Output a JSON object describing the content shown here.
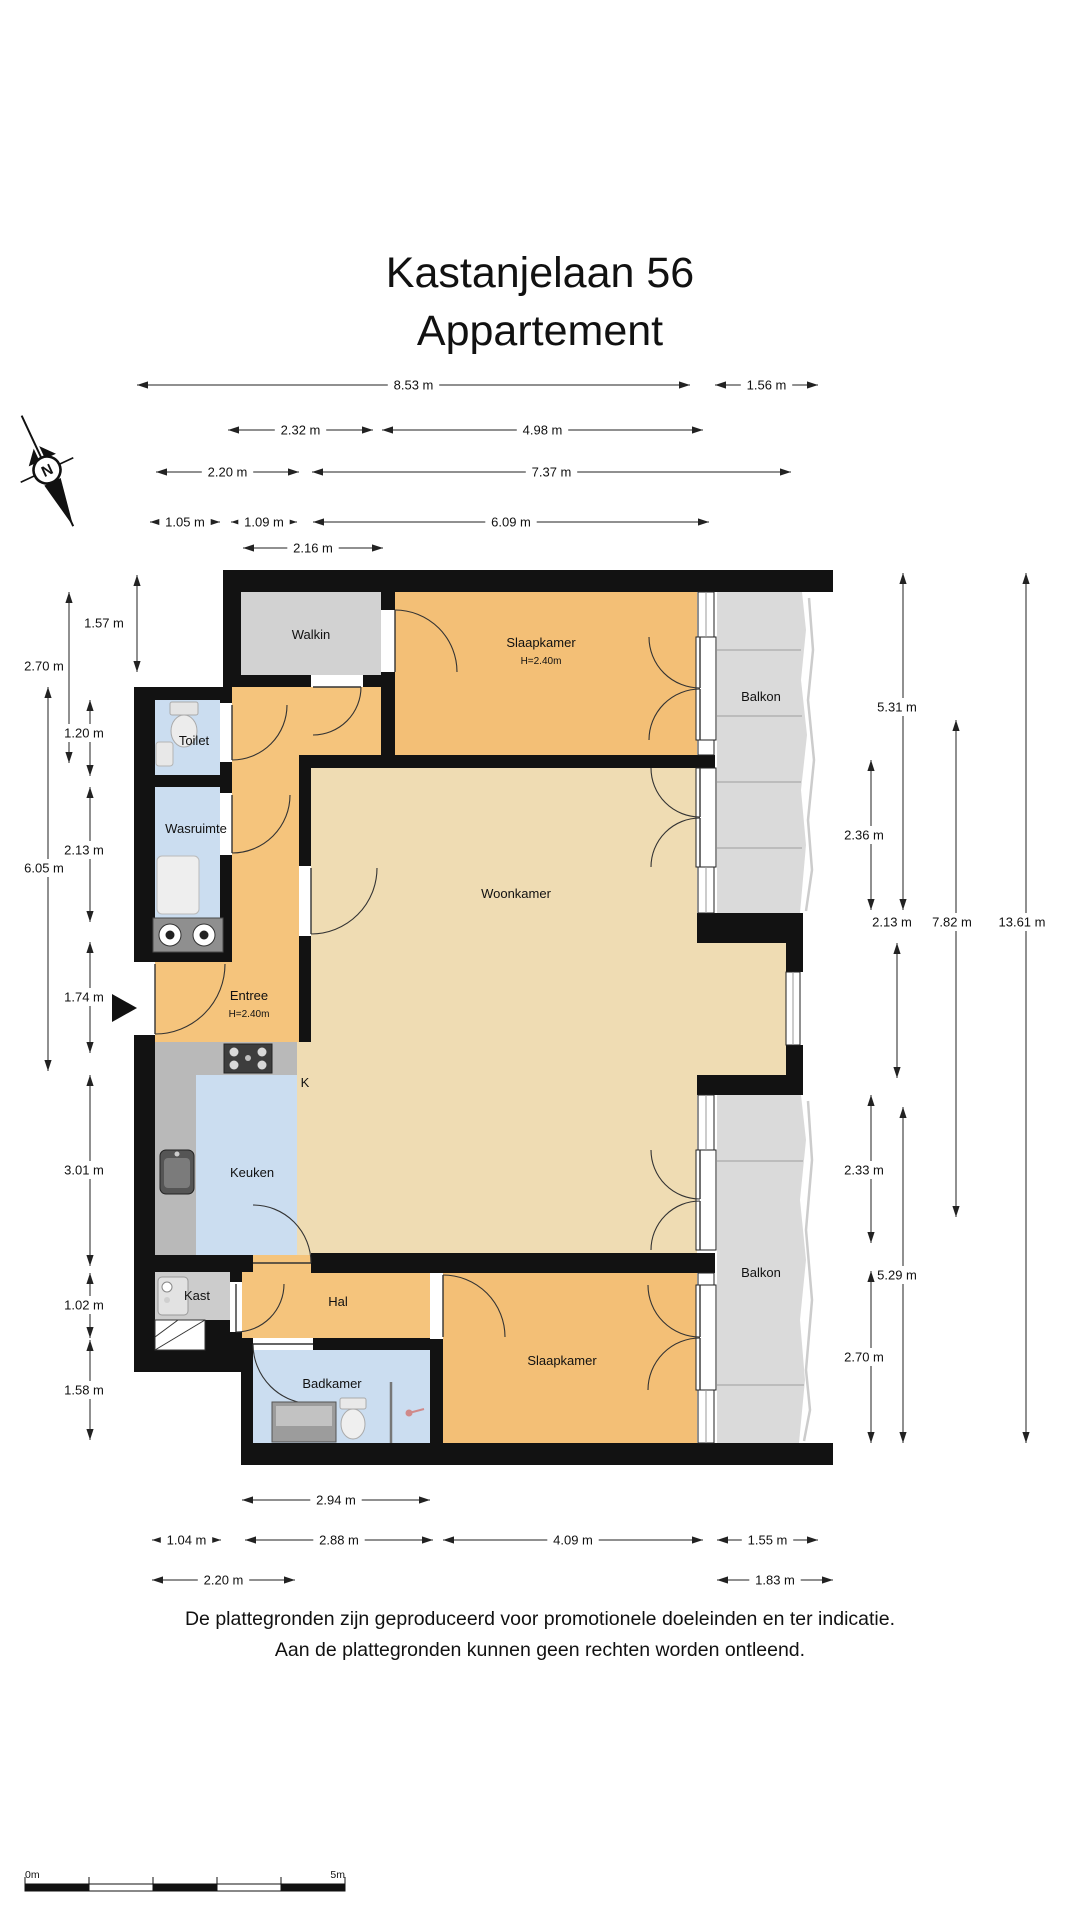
{
  "title": {
    "line1": "Kastanjelaan 56",
    "line2": "Appartement"
  },
  "compass": {
    "label": "N"
  },
  "colors": {
    "wall": "#121212",
    "hall_orange": "#f5c47c",
    "bedroom_orange": "#f3bf76",
    "living_tan": "#efdcb3",
    "wet_blue": "#cbddf0",
    "walkin_grey": "#d2d2d2",
    "balcony_grey": "#dadada",
    "counter_grey": "#b9b9b9"
  },
  "rooms": [
    {
      "name": "walkin",
      "label": "Walkin",
      "x": 311,
      "y": 639
    },
    {
      "name": "slaapkamer-top",
      "label": "Slaapkamer",
      "sublabel": "H=2.40m",
      "x": 541,
      "y": 647,
      "sub_y": 664
    },
    {
      "name": "balkon-top",
      "label": "Balkon",
      "x": 761,
      "y": 701
    },
    {
      "name": "toilet",
      "label": "Toilet",
      "x": 194,
      "y": 745
    },
    {
      "name": "wasruimte",
      "label": "Wasruimte",
      "x": 196,
      "y": 833
    },
    {
      "name": "woonkamer",
      "label": "Woonkamer",
      "x": 516,
      "y": 898
    },
    {
      "name": "entree",
      "label": "Entree",
      "sublabel": "H=2.40m",
      "x": 249,
      "y": 1000,
      "sub_y": 1017
    },
    {
      "name": "keuken-k",
      "label": "K",
      "x": 305,
      "y": 1087
    },
    {
      "name": "keuken",
      "label": "Keuken",
      "x": 252,
      "y": 1177
    },
    {
      "name": "kast",
      "label": "Kast",
      "x": 197,
      "y": 1300
    },
    {
      "name": "hal",
      "label": "Hal",
      "x": 338,
      "y": 1306
    },
    {
      "name": "badkamer",
      "label": "Badkamer",
      "x": 332,
      "y": 1388
    },
    {
      "name": "slaapkamer-bottom",
      "label": "Slaapkamer",
      "x": 562,
      "y": 1365
    },
    {
      "name": "balkon-bottom",
      "label": "Balkon",
      "x": 761,
      "y": 1277
    }
  ],
  "dimensions": {
    "horizontal": [
      {
        "label": "8.53 m",
        "y": 385,
        "x1": 137,
        "x2": 690
      },
      {
        "label": "1.56 m",
        "y": 385,
        "x1": 715,
        "x2": 818
      },
      {
        "label": "2.32 m",
        "y": 430,
        "x1": 228,
        "x2": 373
      },
      {
        "label": "4.98 m",
        "y": 430,
        "x1": 382,
        "x2": 703
      },
      {
        "label": "2.20 m",
        "y": 472,
        "x1": 156,
        "x2": 299
      },
      {
        "label": "7.37 m",
        "y": 472,
        "x1": 312,
        "x2": 791
      },
      {
        "label": "1.05 m",
        "y": 522,
        "x1": 150,
        "x2": 220
      },
      {
        "label": "1.09 m",
        "y": 522,
        "x1": 231,
        "x2": 297
      },
      {
        "label": "6.09 m",
        "y": 522,
        "x1": 313,
        "x2": 709
      },
      {
        "label": "2.16 m",
        "y": 548,
        "x1": 243,
        "x2": 383
      },
      {
        "label": "2.94 m",
        "y": 1500,
        "x1": 242,
        "x2": 430
      },
      {
        "label": "1.04 m",
        "y": 1540,
        "x1": 152,
        "x2": 221
      },
      {
        "label": "2.88 m",
        "y": 1540,
        "x1": 245,
        "x2": 433
      },
      {
        "label": "4.09 m",
        "y": 1540,
        "x1": 443,
        "x2": 703
      },
      {
        "label": "1.55 m",
        "y": 1540,
        "x1": 717,
        "x2": 818
      },
      {
        "label": "2.20 m",
        "y": 1580,
        "x1": 152,
        "x2": 295
      },
      {
        "label": "1.83 m",
        "y": 1580,
        "x1": 717,
        "x2": 833
      }
    ],
    "vertical": [
      {
        "label": "1.57 m",
        "x": 137,
        "y1": 575,
        "y2": 672,
        "lx": 104,
        "ly": 623,
        "bg": false
      },
      {
        "label": "2.70 m",
        "x": 69,
        "y1": 592,
        "y2": 763,
        "lx": 44,
        "ly": 666,
        "bg": false
      },
      {
        "label": "1.20 m",
        "x": 90,
        "y1": 700,
        "y2": 776,
        "lx": 84,
        "ly": 733,
        "bg": true
      },
      {
        "label": "2.13 m",
        "x": 90,
        "y1": 787,
        "y2": 922,
        "lx": 84,
        "ly": 850,
        "bg": true
      },
      {
        "label": "6.05 m",
        "x": 48,
        "y1": 687,
        "y2": 1071,
        "lx": 44,
        "ly": 868,
        "bg": true
      },
      {
        "label": "1.74 m",
        "x": 90,
        "y1": 942,
        "y2": 1053,
        "lx": 84,
        "ly": 997,
        "bg": true
      },
      {
        "label": "3.01 m",
        "x": 90,
        "y1": 1075,
        "y2": 1266,
        "lx": 84,
        "ly": 1170,
        "bg": true
      },
      {
        "label": "1.02 m",
        "x": 90,
        "y1": 1273,
        "y2": 1338,
        "lx": 84,
        "ly": 1305,
        "bg": true
      },
      {
        "label": "1.58 m",
        "x": 90,
        "y1": 1340,
        "y2": 1440,
        "lx": 84,
        "ly": 1390,
        "bg": true
      },
      {
        "label": "5.31 m",
        "x": 903,
        "y1": 573,
        "y2": 910,
        "lx": 897,
        "ly": 707,
        "bg": true
      },
      {
        "label": "2.36 m",
        "x": 871,
        "y1": 760,
        "y2": 910,
        "lx": 864,
        "ly": 835,
        "bg": true
      },
      {
        "label": "2.13 m",
        "x": 897,
        "y1": 943,
        "y2": 1078,
        "lx": 892,
        "ly": 922,
        "bg": false
      },
      {
        "label": "7.82 m",
        "x": 956,
        "y1": 720,
        "y2": 1217,
        "lx": 952,
        "ly": 922,
        "bg": true
      },
      {
        "label": "13.61 m",
        "x": 1026,
        "y1": 573,
        "y2": 1443,
        "lx": 1022,
        "ly": 922,
        "bg": true
      },
      {
        "label": "2.33 m",
        "x": 871,
        "y1": 1095,
        "y2": 1243,
        "lx": 864,
        "ly": 1170,
        "bg": true
      },
      {
        "label": "5.29 m",
        "x": 903,
        "y1": 1107,
        "y2": 1443,
        "lx": 897,
        "ly": 1275,
        "bg": true
      },
      {
        "label": "2.70 m",
        "x": 871,
        "y1": 1271,
        "y2": 1443,
        "lx": 864,
        "ly": 1357,
        "bg": true
      }
    ]
  },
  "disclaimer": {
    "line1": "De plattegronden zijn geproduceerd voor promotionele doeleinden en ter indicatie.",
    "line2": "Aan de plattegronden kunnen geen rechten worden ontleend."
  },
  "scalebar": {
    "start": "0m",
    "end": "5m"
  }
}
